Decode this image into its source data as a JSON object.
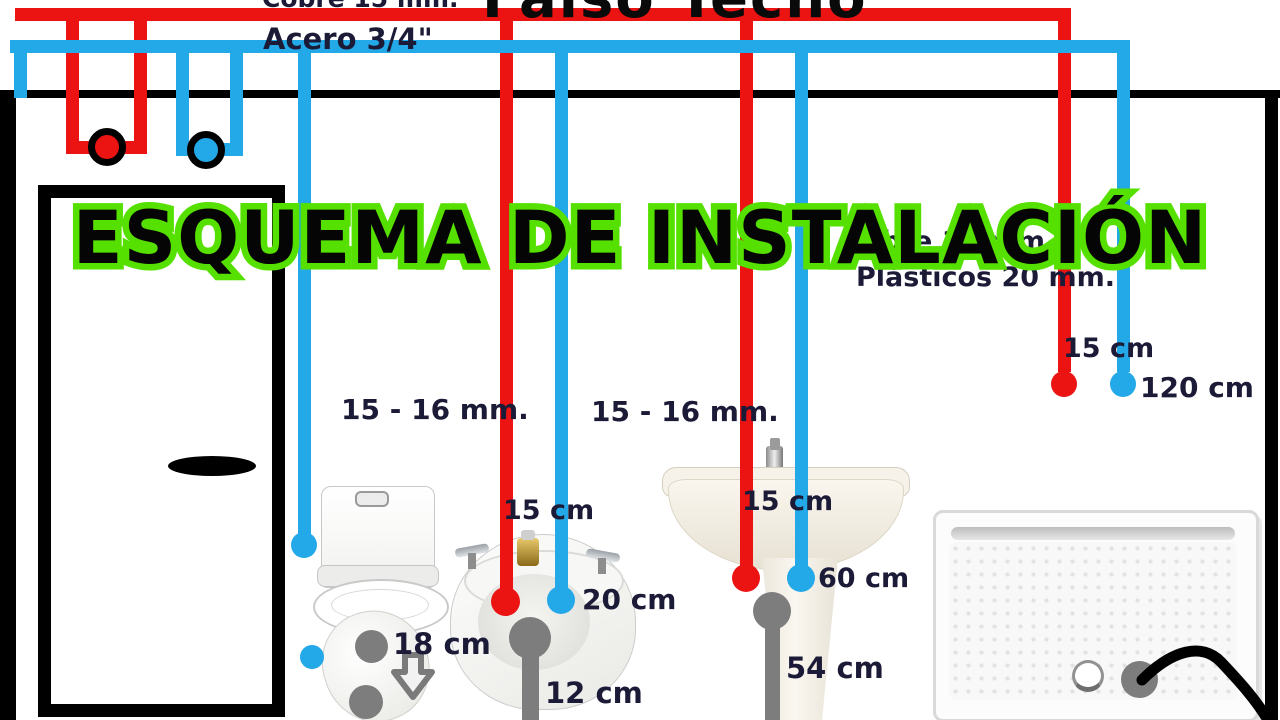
{
  "diagram_title": "ESQUEMA DE INSTALACIÓN",
  "ceiling_labels": {
    "copper_main": "Cobre 15 mm.",
    "steel_main": "Acero 3/4\"",
    "false_ceiling": "Falso Techo"
  },
  "branch_labels": {
    "copper_branch": "Cobre 18 mm",
    "plastic_branch": "Plásticos 20 mm."
  },
  "pipe_size_labels": {
    "bidet_branch": "15 - 16 mm.",
    "sink_branch": "15 - 16 mm."
  },
  "measurements": {
    "shower_hot_offset": "15 cm",
    "shower_cold_height": "120 cm",
    "bidet_hot_offset": "15 cm",
    "bidet_tap_spacing": "20 cm",
    "bidet_drain_offset": "12 cm",
    "toilet_drain_offset": "18 cm",
    "sink_hot_offset": "15 cm",
    "sink_tap_spacing": "60 cm",
    "sink_drain_height": "54 cm"
  },
  "legend_colors": {
    "hot_water": "#ec1313",
    "cold_water": "#23a8e8",
    "drain": "#7d7d7d",
    "title_outline": "#55e000"
  }
}
